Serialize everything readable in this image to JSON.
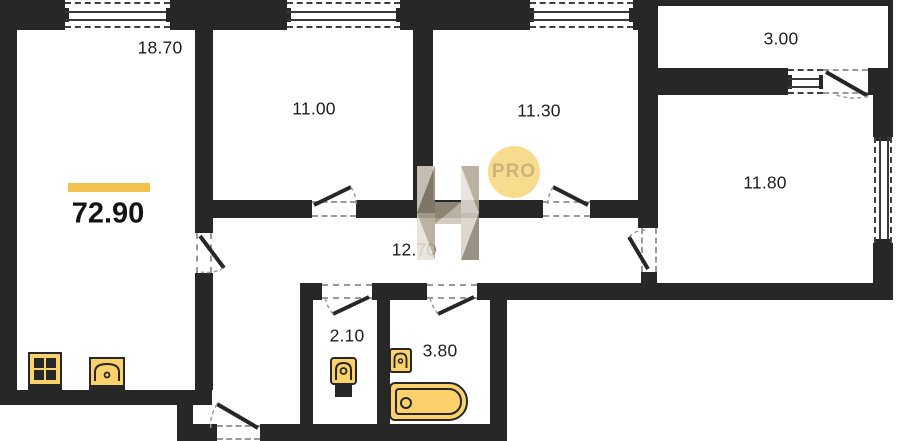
{
  "plan": {
    "total_area": "72.90",
    "rooms": [
      {
        "id": "living-kitchen",
        "area": "18.70"
      },
      {
        "id": "room-mid-left",
        "area": "11.00"
      },
      {
        "id": "room-mid-right",
        "area": "11.30"
      },
      {
        "id": "balcony",
        "area": "3.00"
      },
      {
        "id": "room-right",
        "area": "11.80"
      },
      {
        "id": "hallway",
        "area": "12.70"
      },
      {
        "id": "wc",
        "area": "2.10"
      },
      {
        "id": "bathroom",
        "area": "3.80"
      }
    ]
  },
  "watermark": {
    "letter": "H",
    "badge_label": "PRO"
  },
  "colors": {
    "wall": "#272727",
    "accent_bar": "#F2C14E",
    "fixture_fill": "#FBD16C",
    "badge_bg": "#F8DC8E",
    "badge_text": "#CBB27E"
  },
  "icons": [
    "stove-icon",
    "kitchen-sink-icon",
    "toilet-icon",
    "washbasin-icon",
    "bathtub-icon"
  ]
}
